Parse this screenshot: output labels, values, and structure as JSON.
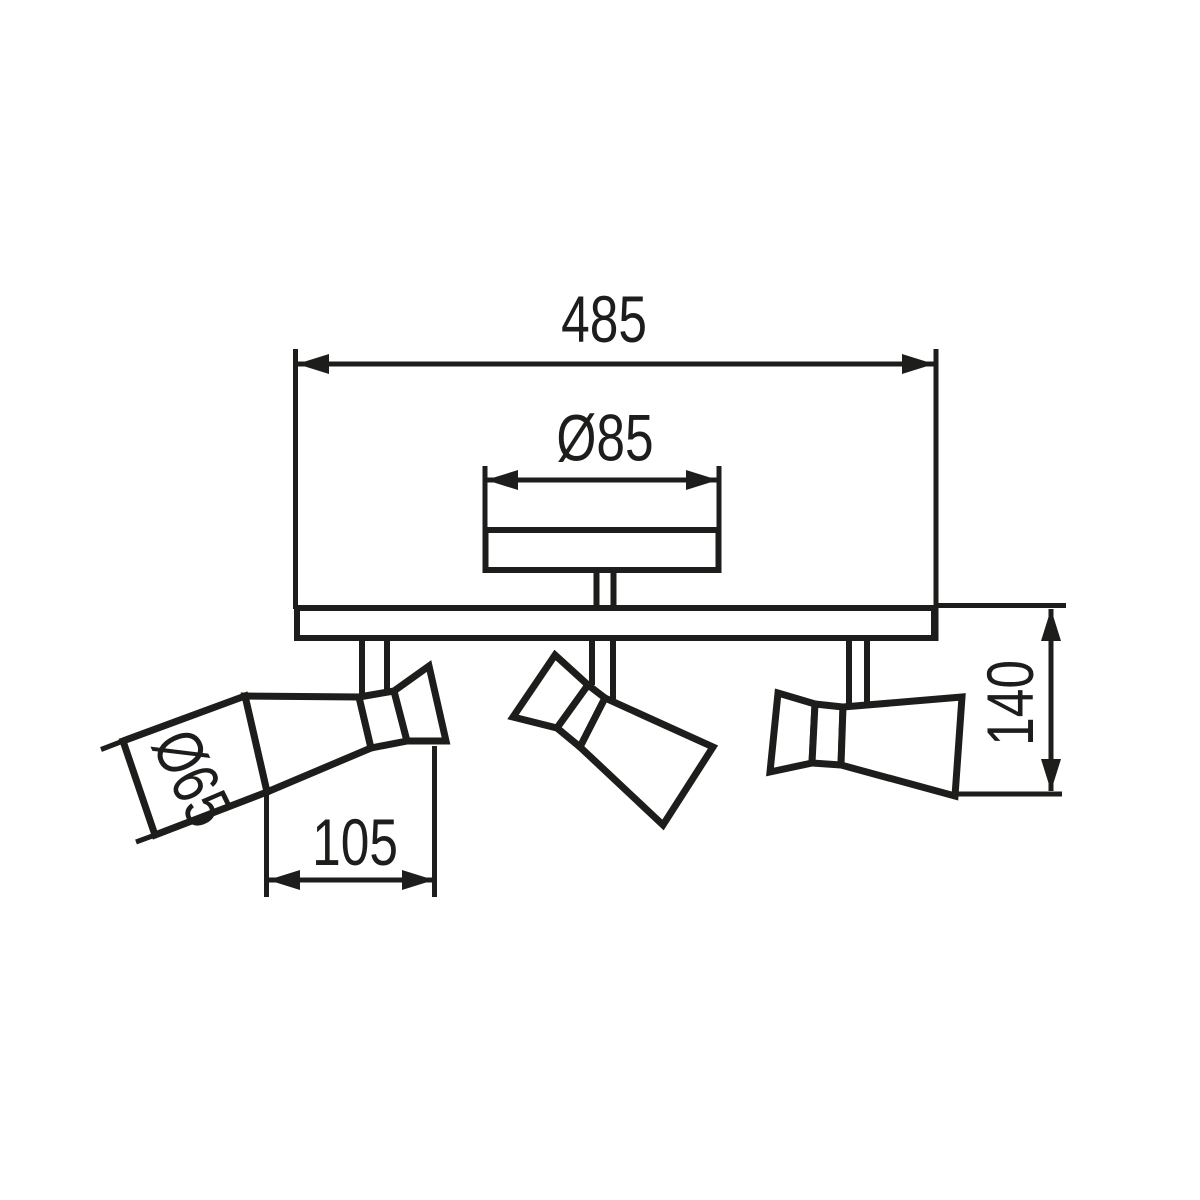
{
  "labels": {
    "total_width": "485",
    "canopy_diameter": "Ø85",
    "head_diameter": "Ø65",
    "head_length": "105",
    "fixture_height": "140"
  },
  "colors": {
    "line": "#1d1d1b",
    "background": "#ffffff"
  }
}
